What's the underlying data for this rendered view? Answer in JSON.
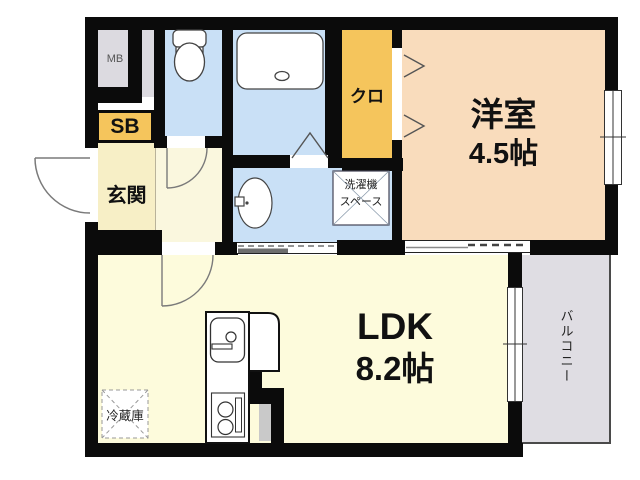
{
  "rooms": {
    "western_room": {
      "name": "洋室",
      "size": "4.5帖",
      "color": "#F9DCBC"
    },
    "ldk": {
      "name": "LDK",
      "size": "8.2帖",
      "color": "#FDFBDC"
    },
    "genkan": {
      "name": "玄関",
      "color": "#F7EFC6"
    },
    "closet": {
      "name": "クロ",
      "color": "#F5C55C"
    },
    "balcony": {
      "name": "バルコニー",
      "color": "#DFDDE3"
    },
    "shoe_box": {
      "name": "SB",
      "color": "#F5C55C"
    },
    "meter_box": {
      "name": "MB",
      "color": "#DCDAE0"
    },
    "bathroom": {
      "color": "#C9E0F6"
    },
    "toilet": {
      "color": "#C9E0F6"
    },
    "washroom": {
      "color": "#C9E0F6"
    }
  },
  "fixtures": {
    "washer_space": {
      "line1": "洗濯機",
      "line2": "スペース"
    },
    "refrigerator": {
      "name": "冷蔵庫"
    }
  },
  "wall_color": "#0B0B0B"
}
